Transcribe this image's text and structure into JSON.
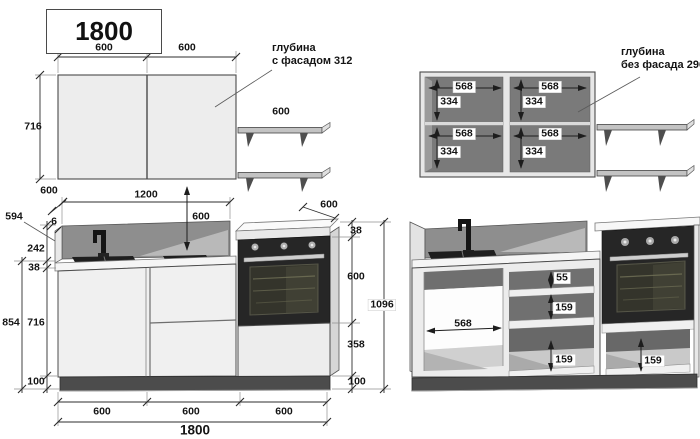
{
  "title": "1800",
  "annotations": {
    "depth_with_facade": {
      "line1": "глубина",
      "line2": "с фасадом 312"
    },
    "depth_without_facade": {
      "line1": "глубина",
      "line2": "без фасада 296"
    }
  },
  "upper_front": {
    "w1": "600",
    "w2": "600",
    "h": "716",
    "shelf_w": "600"
  },
  "upper_open": {
    "tl_w": "568",
    "tl_h": "334",
    "tr_w": "568",
    "tr_h": "334",
    "bl_w": "568",
    "bl_h": "334",
    "br_w": "568",
    "br_h": "334"
  },
  "base_front": {
    "depth": "600",
    "span": "1200",
    "gap": "600",
    "backsplash_len": "594",
    "panel": "6",
    "backsplash_h": "242",
    "counter_t": "38",
    "left_total": "854",
    "door_h": "716",
    "plinth": "100",
    "oven_depth": "600",
    "right_counter_t": "38",
    "oven_h": "600",
    "under_oven": "358",
    "right_plinth": "100",
    "right_total": "1096",
    "b1": "600",
    "b2": "600",
    "b3": "600",
    "total": "1800"
  },
  "base_open": {
    "opening_w": "568",
    "drawer1": "55",
    "drawer2": "159",
    "drawer3": "159",
    "oven_drawer": "159"
  }
}
